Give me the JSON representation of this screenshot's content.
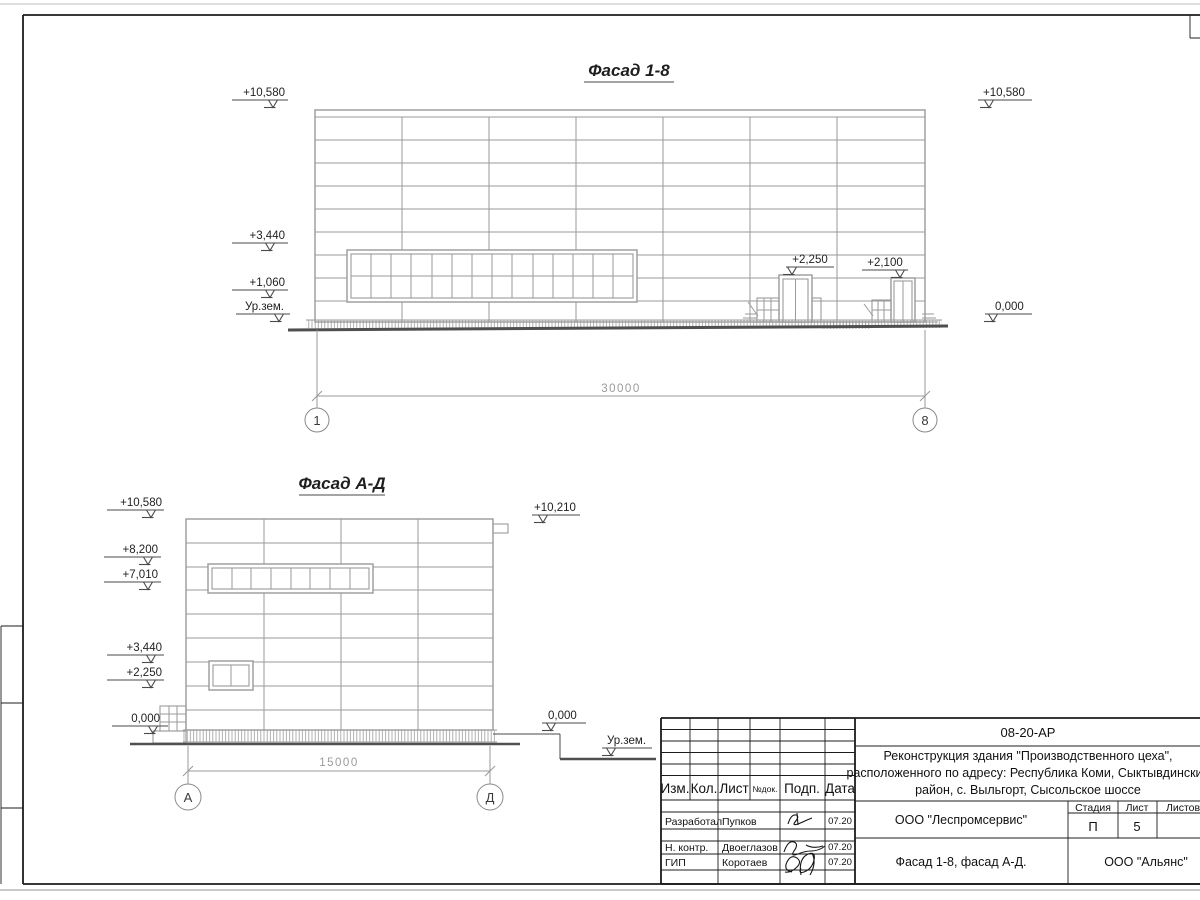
{
  "sheet": {
    "facade_1_8": {
      "title": "Фасад 1-8",
      "elev": {
        "l1": "+10,580",
        "l2": "+3,440",
        "l3": "+1,060",
        "l4": "Ур.зем.",
        "r1": "+10,580",
        "r2": "0,000",
        "door1": "+2,250",
        "door2": "+2,100"
      },
      "dim": "30000",
      "axis1": "1",
      "axis2": "8"
    },
    "facade_a_d": {
      "title": "Фасад А-Д",
      "elev": {
        "l1": "+10,580",
        "l2": "+8,200",
        "l3": "+7,010",
        "l4": "+3,440",
        "l5": "+2,250",
        "l6": "0,000",
        "r1": "+10,210",
        "r2": "0,000",
        "ground": "Ур.зем."
      },
      "dim": "15000",
      "axis1": "А",
      "axis2": "Д"
    },
    "title_block": {
      "code": "08-20-АР",
      "project": {
        "line1": "Реконструкция здания \"Производственного цеха\",",
        "line2": "расположенного по адресу: Республика Коми, Сыктывдинский",
        "line3": "район, с. Выльгорт, Сысольское шоссе"
      },
      "columns": {
        "izm": "Изм.",
        "kol": "Кол.",
        "list": "Лист",
        "doc": "№док.",
        "podp": "Подп.",
        "data": "Дата"
      },
      "rows": [
        {
          "role": "Разработал",
          "name": "Пупков",
          "date": "07.20"
        },
        {
          "role": "Н. контр.",
          "name": "Двоеглазов",
          "date": "07.20"
        },
        {
          "role": "ГИП",
          "name": "Коротаев",
          "date": "07.20"
        }
      ],
      "org": "ООО \"Леспромсервис\"",
      "stage_label": "Стадия",
      "sheet_label": "Лист",
      "sheets_label": "Листов",
      "stage": "П",
      "sheet_no": "5",
      "sheets_total": "",
      "sheet_title": "Фасад 1-8, фасад А-Д.",
      "contractor": "ООО \"Альянс\""
    },
    "colors": {
      "line_gray": "#9a9a9a",
      "ink": "#1c1c1c",
      "dim_gray": "#9b9b9b"
    }
  }
}
